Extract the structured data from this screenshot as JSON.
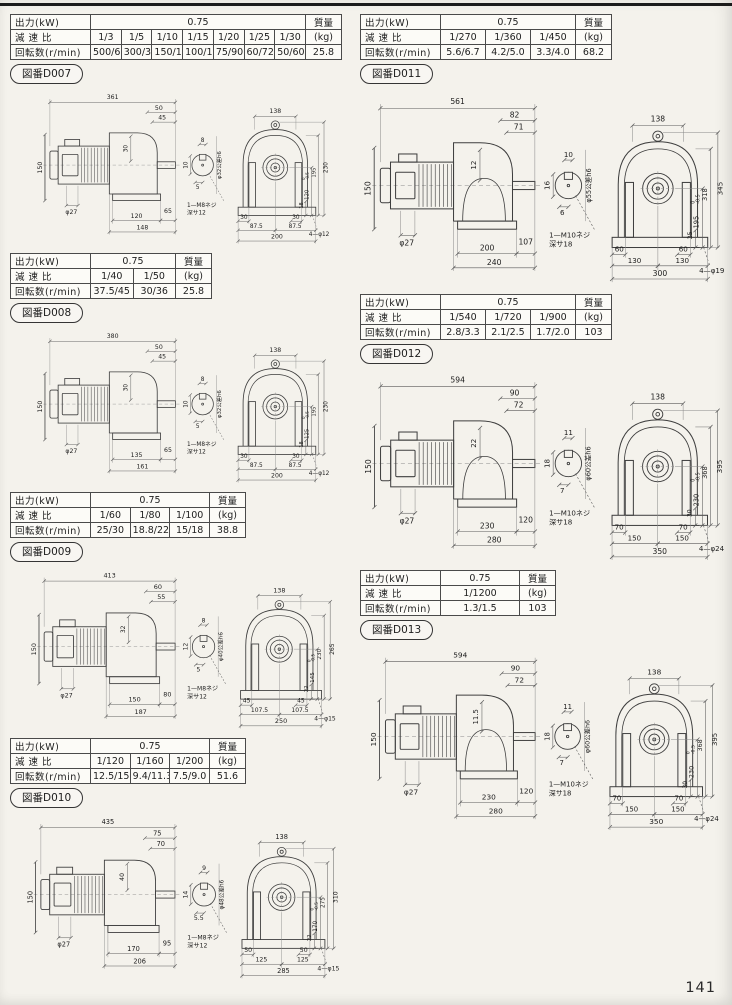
{
  "page": {
    "number": "141",
    "labels": {
      "output": "出力(kW)",
      "ratio": "減 速 比",
      "speed": "回転数(r/min)",
      "mass": "質量",
      "kg": "(kg)"
    }
  },
  "blocks": [
    {
      "fig_no": "D007",
      "fig_label": "図番D007",
      "table": {
        "output": "0.75",
        "ratios": [
          "1/3",
          "1/5",
          "1/10",
          "1/15",
          "1/20",
          "1/25",
          "1/30"
        ],
        "speeds": [
          "500/600",
          "300/360",
          "150/180",
          "100/120",
          "75/90",
          "60/72",
          "50/60"
        ],
        "mass": "25.8"
      },
      "dims": {
        "total": "361",
        "top1": "50",
        "top2": "45",
        "body": "30",
        "height": "150",
        "mshaft": "φ27",
        "base1": "120",
        "gap": "65",
        "base2": "148",
        "key_top": "8",
        "key_side": "10",
        "key_bot": "5",
        "shaft_dia": "φ32公差h6",
        "screw": "1—M8ネジ",
        "depth": "深サ12",
        "flange": "138",
        "overall": "230",
        "inner": "195",
        "mount": "120",
        "tol_u": "0",
        "tol_l": "-0.5",
        "toe": "18",
        "foot1": "30",
        "foot2": "30",
        "center1": "87.5",
        "center2": "87.5",
        "base_w": "200",
        "holes": "4—φ12"
      }
    },
    {
      "fig_no": "D008",
      "fig_label": "図番D008",
      "table": {
        "output": "0.75",
        "ratios": [
          "1/40",
          "1/50"
        ],
        "speeds": [
          "37.5/45",
          "30/36"
        ],
        "mass": "25.8"
      },
      "dims": {
        "total": "380",
        "top1": "50",
        "top2": "45",
        "body": "30",
        "height": "150",
        "mshaft": "φ27",
        "base1": "135",
        "gap": "65",
        "base2": "161",
        "key_top": "8",
        "key_side": "10",
        "key_bot": "5",
        "shaft_dia": "φ32公差h6",
        "screw": "1—M8ネジ",
        "depth": "深サ12",
        "flange": "138",
        "overall": "230",
        "inner": "195",
        "mount": "125",
        "tol_u": "0",
        "tol_l": "-0.5",
        "toe": "18",
        "foot1": "30",
        "foot2": "30",
        "center1": "87.5",
        "center2": "87.5",
        "base_w": "200",
        "holes": "4—φ12"
      }
    },
    {
      "fig_no": "D009",
      "fig_label": "図番D009",
      "table": {
        "output": "0.75",
        "ratios": [
          "1/60",
          "1/80",
          "1/100"
        ],
        "speeds": [
          "25/30",
          "18.8/22.5",
          "15/18"
        ],
        "mass": "38.8"
      },
      "dims": {
        "total": "413",
        "top1": "60",
        "top2": "55",
        "body": "32",
        "height": "150",
        "mshaft": "φ27",
        "base1": "150",
        "gap": "80",
        "base2": "187",
        "key_top": "8",
        "key_side": "12",
        "key_bot": "5",
        "shaft_dia": "φ40公差h6",
        "screw": "1—M8ネジ",
        "depth": "深サ12",
        "flange": "138",
        "overall": "265",
        "inner": "230",
        "mount": "145",
        "tol_u": "0",
        "tol_l": "-0.5",
        "toe": "22",
        "foot1": "45",
        "foot2": "45",
        "center1": "107.5",
        "center2": "107.5",
        "base_w": "250",
        "holes": "4—φ15"
      }
    },
    {
      "fig_no": "D010",
      "fig_label": "図番D010",
      "table": {
        "output": "0.75",
        "ratios": [
          "1/120",
          "1/160",
          "1/200"
        ],
        "speeds": [
          "12.5/15",
          "9.4/11.3",
          "7.5/9.0"
        ],
        "mass": "51.6"
      },
      "dims": {
        "total": "435",
        "top1": "75",
        "top2": "70",
        "body": "40",
        "height": "150",
        "mshaft": "φ27",
        "base1": "170",
        "gap": "95",
        "base2": "206",
        "key_top": "9",
        "key_side": "14",
        "key_bot": "5.5",
        "shaft_dia": "φ48公差h6",
        "screw": "1—M8ネジ",
        "depth": "深サ12",
        "flange": "138",
        "overall": "310",
        "inner": "275",
        "mount": "170",
        "tol_u": "0",
        "tol_l": "-0.5",
        "toe": "22",
        "foot1": "50",
        "foot2": "50",
        "center1": "125",
        "center2": "125",
        "base_w": "285",
        "holes": "4—φ15"
      }
    },
    {
      "fig_no": "D011",
      "fig_label": "図番D011",
      "table": {
        "output": "0.75",
        "ratios": [
          "1/270",
          "1/360",
          "1/450"
        ],
        "speeds": [
          "5.6/6.7",
          "4.2/5.0",
          "3.3/4.0"
        ],
        "mass": "68.2"
      },
      "dims": {
        "total": "561",
        "top1": "82",
        "top2": "71",
        "body": "12",
        "height": "150",
        "mshaft": "φ27",
        "base1": "200",
        "gap": "107",
        "base2": "240",
        "key_top": "10",
        "key_side": "16",
        "key_bot": "6",
        "shaft_dia": "φ55公差h6",
        "screw": "1—M10ネジ",
        "depth": "深サ18",
        "flange": "138",
        "overall": "345",
        "inner": "318",
        "mount": "195",
        "tol_u": "0",
        "tol_l": "-0.5",
        "toe": "25",
        "foot1": "60",
        "foot2": "60",
        "center1": "130",
        "center2": "130",
        "base_w": "300",
        "holes": "4—φ19"
      }
    },
    {
      "fig_no": "D012",
      "fig_label": "図番D012",
      "table": {
        "output": "0.75",
        "ratios": [
          "1/540",
          "1/720",
          "1/900"
        ],
        "speeds": [
          "2.8/3.3",
          "2.1/2.5",
          "1.7/2.0"
        ],
        "mass": "103"
      },
      "dims": {
        "total": "594",
        "top1": "90",
        "top2": "72",
        "body": "22",
        "height": "150",
        "mshaft": "φ27",
        "base1": "230",
        "gap": "120",
        "base2": "280",
        "key_top": "11",
        "key_side": "18",
        "key_bot": "7",
        "shaft_dia": "φ60公差h6",
        "screw": "1—M10ネジ",
        "depth": "深サ18",
        "flange": "138",
        "overall": "395",
        "inner": "368",
        "mount": "230",
        "tol_u": "0",
        "tol_l": "-0.5",
        "toe": "30",
        "foot1": "70",
        "foot2": "70",
        "center1": "150",
        "center2": "150",
        "base_w": "350",
        "holes": "4—φ24"
      }
    },
    {
      "fig_no": "D013",
      "fig_label": "図番D013",
      "table": {
        "output": "0.75",
        "ratios": [
          "1/1200"
        ],
        "speeds": [
          "1.3/1.5"
        ],
        "mass": "103"
      },
      "dims": {
        "total": "594",
        "top1": "90",
        "top2": "72",
        "body": "11.5",
        "height": "150",
        "mshaft": "φ27",
        "base1": "230",
        "gap": "120",
        "base2": "280",
        "key_top": "11",
        "key_side": "18",
        "key_bot": "7",
        "shaft_dia": "φ60公差h6",
        "screw": "1—M10ネジ",
        "depth": "深サ18",
        "flange": "138",
        "overall": "395",
        "inner": "368",
        "mount": "230",
        "tol_u": "0",
        "tol_l": "-0.5",
        "toe": "30",
        "foot1": "70",
        "foot2": "70",
        "center1": "150",
        "center2": "150",
        "base_w": "350",
        "holes": "4—φ24"
      }
    }
  ]
}
